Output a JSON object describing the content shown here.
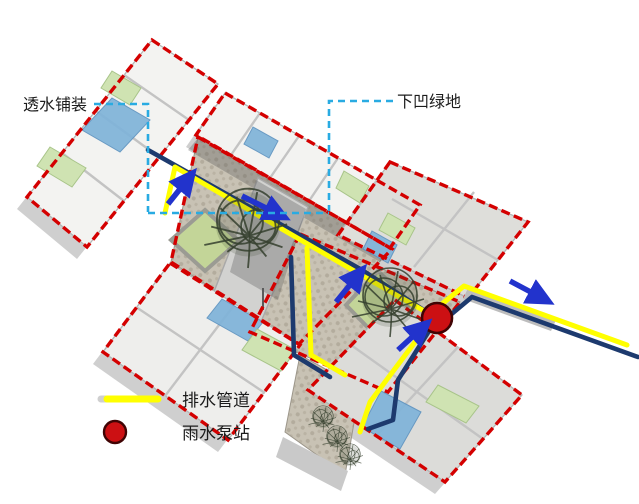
{
  "diagram": {
    "type": "axonometric site drainage diagram of courtyard compound",
    "labels": {
      "permeable_paving": "透水铺装",
      "sunken_green": "下凹绿地"
    },
    "legend": {
      "items": [
        {
          "swatch": "drain-pipe-line-swatch",
          "label": "排水管道"
        },
        {
          "swatch": "pump-station-circle-swatch",
          "label": "雨水泵站"
        }
      ]
    },
    "colors": {
      "roof_outline_red": "#d40000",
      "drain_pipe_yellow": "#ffff00",
      "storm_pipe_navy": "#1d3a6e",
      "flow_arrow_blue": "#2233cc",
      "callout_cyan": "#29abe2",
      "pump_red": "#cc1013",
      "pump_ring": "#400404",
      "green_floor": "#cfe3b2",
      "blue_floor": "#7fb3d9",
      "planter_green": "#c3d598",
      "paving": "#c8c2b4",
      "tree_green": "#35402e"
    },
    "markers": {
      "pump_station_count": 1,
      "flow_arrow_count": 5
    }
  }
}
